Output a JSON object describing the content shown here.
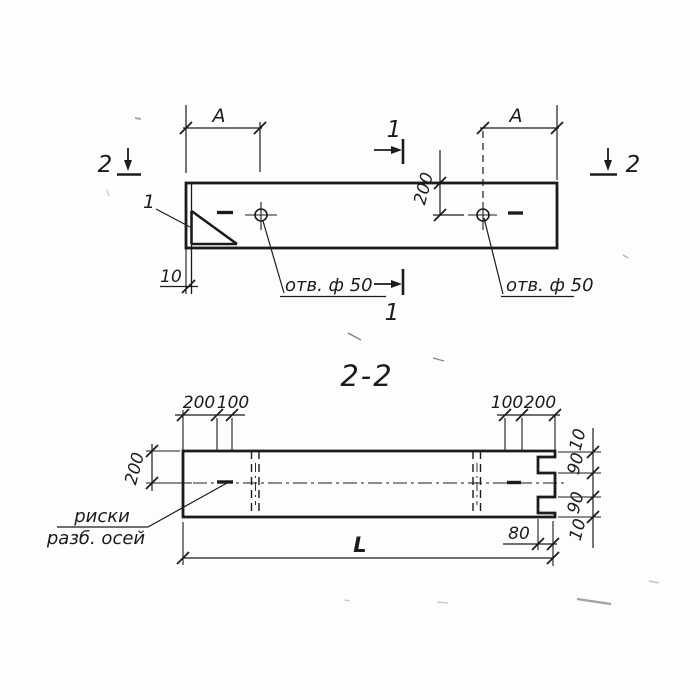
{
  "drawing": {
    "section_title": "2-2",
    "top_view": {
      "marker_2_left": "2",
      "marker_2_right": "2",
      "marker_1_top": "1",
      "marker_1_bottom": "1",
      "detail_ref": "1",
      "dim_a_left": "A",
      "dim_a_right": "A",
      "dim_edge_offset": "200",
      "dim_corner": "10",
      "hole_left_label": "отв. ф 50",
      "hole_right_label": "отв. ф 50"
    },
    "section_view": {
      "dim_height": "200",
      "dim_top_left_200": "200",
      "dim_top_left_100": "100",
      "dim_top_right_100": "100",
      "dim_top_right_200": "200",
      "dim_notch_top_10": "10",
      "dim_notch_top_90": "90",
      "dim_notch_bottom_90": "90",
      "dim_notch_bottom_10": "10",
      "dim_notch_depth": "80",
      "dim_length": "L",
      "axes_note_line1": "риски",
      "axes_note_line2": "разб. осей"
    },
    "colors": {
      "line": "#1b1b1b",
      "background": "#fdfdfd"
    }
  }
}
